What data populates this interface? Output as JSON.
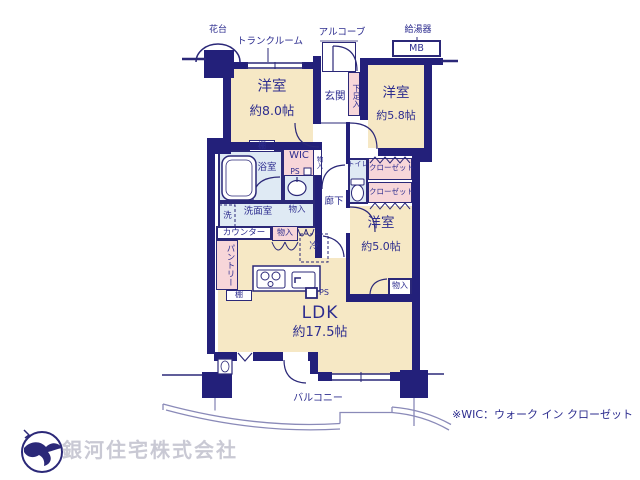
{
  "plan": {
    "labels": {
      "kadai": "花台",
      "trunk_room": "トランクルーム",
      "alcove": "アルコーブ",
      "water_heater": "給湯器",
      "mb": "MB",
      "genkan": "玄関",
      "shoe_box": "下足入",
      "wic": "WIC",
      "ps": "PS",
      "monoire": "物入",
      "bathroom": "浴室",
      "washroom": "洗面室",
      "washer": "洗",
      "corridor": "廊下",
      "toilet": "トイレ",
      "closet": "クローゼット",
      "counter": "カウンター",
      "fridge": "冷",
      "pantry": "パントリー",
      "shelf": "棚",
      "balcony": "バルコニー"
    },
    "rooms": {
      "western1": {
        "name": "洋室",
        "size": "約8.0帖"
      },
      "western2": {
        "name": "洋室",
        "size": "約5.8帖"
      },
      "western3": {
        "name": "洋室",
        "size": "約5.0帖"
      },
      "ldk": {
        "name": "LDK",
        "size": "約17.5帖"
      }
    },
    "note": "※WIC：ウォーク イン クローゼット",
    "company": "銀河住宅株式会社",
    "colors": {
      "wall": "#23207a",
      "room_fill": "#f6e8c5",
      "wet_fill": "#dfeaf4",
      "storage_fill": "#f7d6d9",
      "text": "#2d2d8f",
      "balcony_line": "#8a8ab8",
      "logo_text": "#c9c9d4"
    }
  }
}
